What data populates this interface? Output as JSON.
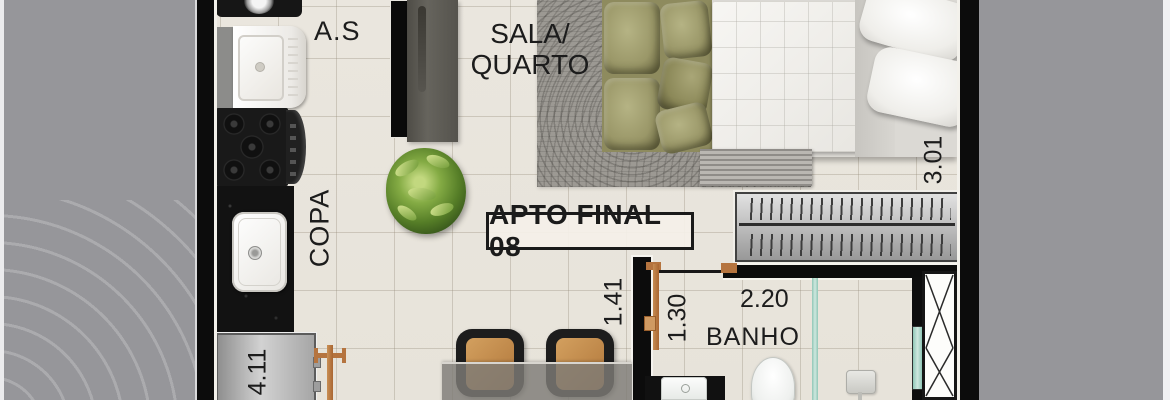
{
  "plan": {
    "title": "APTO FINAL 08",
    "labels": {
      "service_area": "A.S",
      "living_bedroom_line1": "SALA/",
      "living_bedroom_line2": "QUARTO",
      "pantry": "COPA",
      "bathroom": "BANHO"
    },
    "dimensions": {
      "kitchen_run": "4.11",
      "hall_width": "1.41",
      "bath_door_width": "1.30",
      "bath_width": "2.20",
      "bedroom_depth": "3.01"
    },
    "colors": {
      "outside_gray": "#96969a",
      "floor_beige": "#eae6de",
      "wall_black": "#0c0c0c",
      "door_wood": "#b5743f",
      "shower_glass": "#9fd0c0",
      "sofa_green": "#9da06f",
      "chair_wood": "#c08a4c"
    },
    "furniture": [
      "washing-machine",
      "laundry-tank",
      "stove",
      "kitchen-sink",
      "fridge",
      "tv",
      "tv-panel",
      "plant",
      "rug",
      "sofa",
      "bed",
      "bench",
      "wardrobe",
      "dining-table",
      "chair",
      "chair",
      "bathroom-vanity",
      "toilet",
      "shower-head",
      "ventilation-shaft"
    ]
  }
}
